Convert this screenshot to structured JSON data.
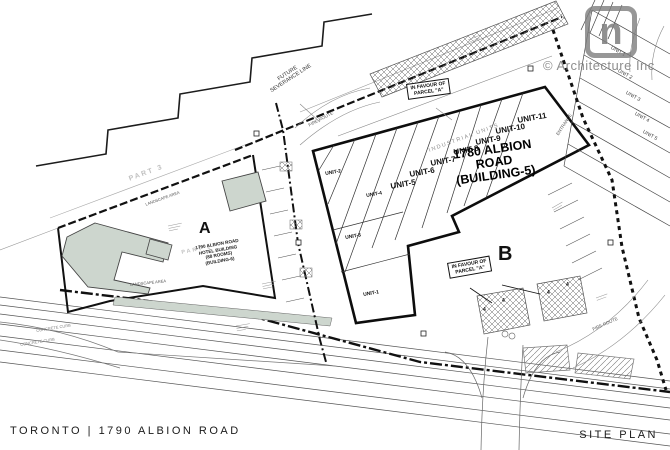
{
  "footer": {
    "project": "TORONTO | 1790 ALBION ROAD",
    "sheet": "SITE PLAN"
  },
  "watermark": {
    "logo_letter": "n",
    "company": "© Architecture Inc"
  },
  "parcels": {
    "a": {
      "id": "A",
      "part": "PART 1",
      "part_adjacent": "PART 3",
      "hotel": {
        "line1": "1790 ALBION ROAD",
        "line2": "HOTEL BUILDING",
        "line3": "(88 ROOMS)",
        "line4": "(BUILDING-6)"
      }
    },
    "b": {
      "id": "B",
      "building": {
        "line1": "1780 ALBION",
        "line2": "ROAD",
        "line3": "(BUILDING-5)"
      },
      "industrial": "INDUSTRIAL UNITS",
      "units_main": [
        "UNIT-5",
        "UNIT-6",
        "UNIT-7",
        "UNIT-8",
        "UNIT-9",
        "UNIT-10",
        "UNIT-11"
      ],
      "units_wing": [
        "UNIT-1",
        "UNIT-2",
        "UNIT-3",
        "UNIT-4"
      ]
    }
  },
  "east_units": [
    "UNIT 1",
    "UNIT 2",
    "UNIT 3",
    "UNIT 4",
    "UNIT 5"
  ],
  "annotations": {
    "future_severance_1": "FUTURE",
    "future_severance_2": "SEVERANCE LINE",
    "in_favour_1": "IN FAVOUR OF",
    "in_favour_2": "PARCEL \"A\"",
    "entrance": "ENTRANCE",
    "fire_route": "FIRE ROUTE",
    "landscape": "LANDSCAPE AREA",
    "curb": "CONCRETE CURB",
    "stall_count": "4"
  },
  "colors": {
    "line": "#1c1c1c",
    "building_fill": "#cdd6ce",
    "gray": "#8f8f8f"
  }
}
